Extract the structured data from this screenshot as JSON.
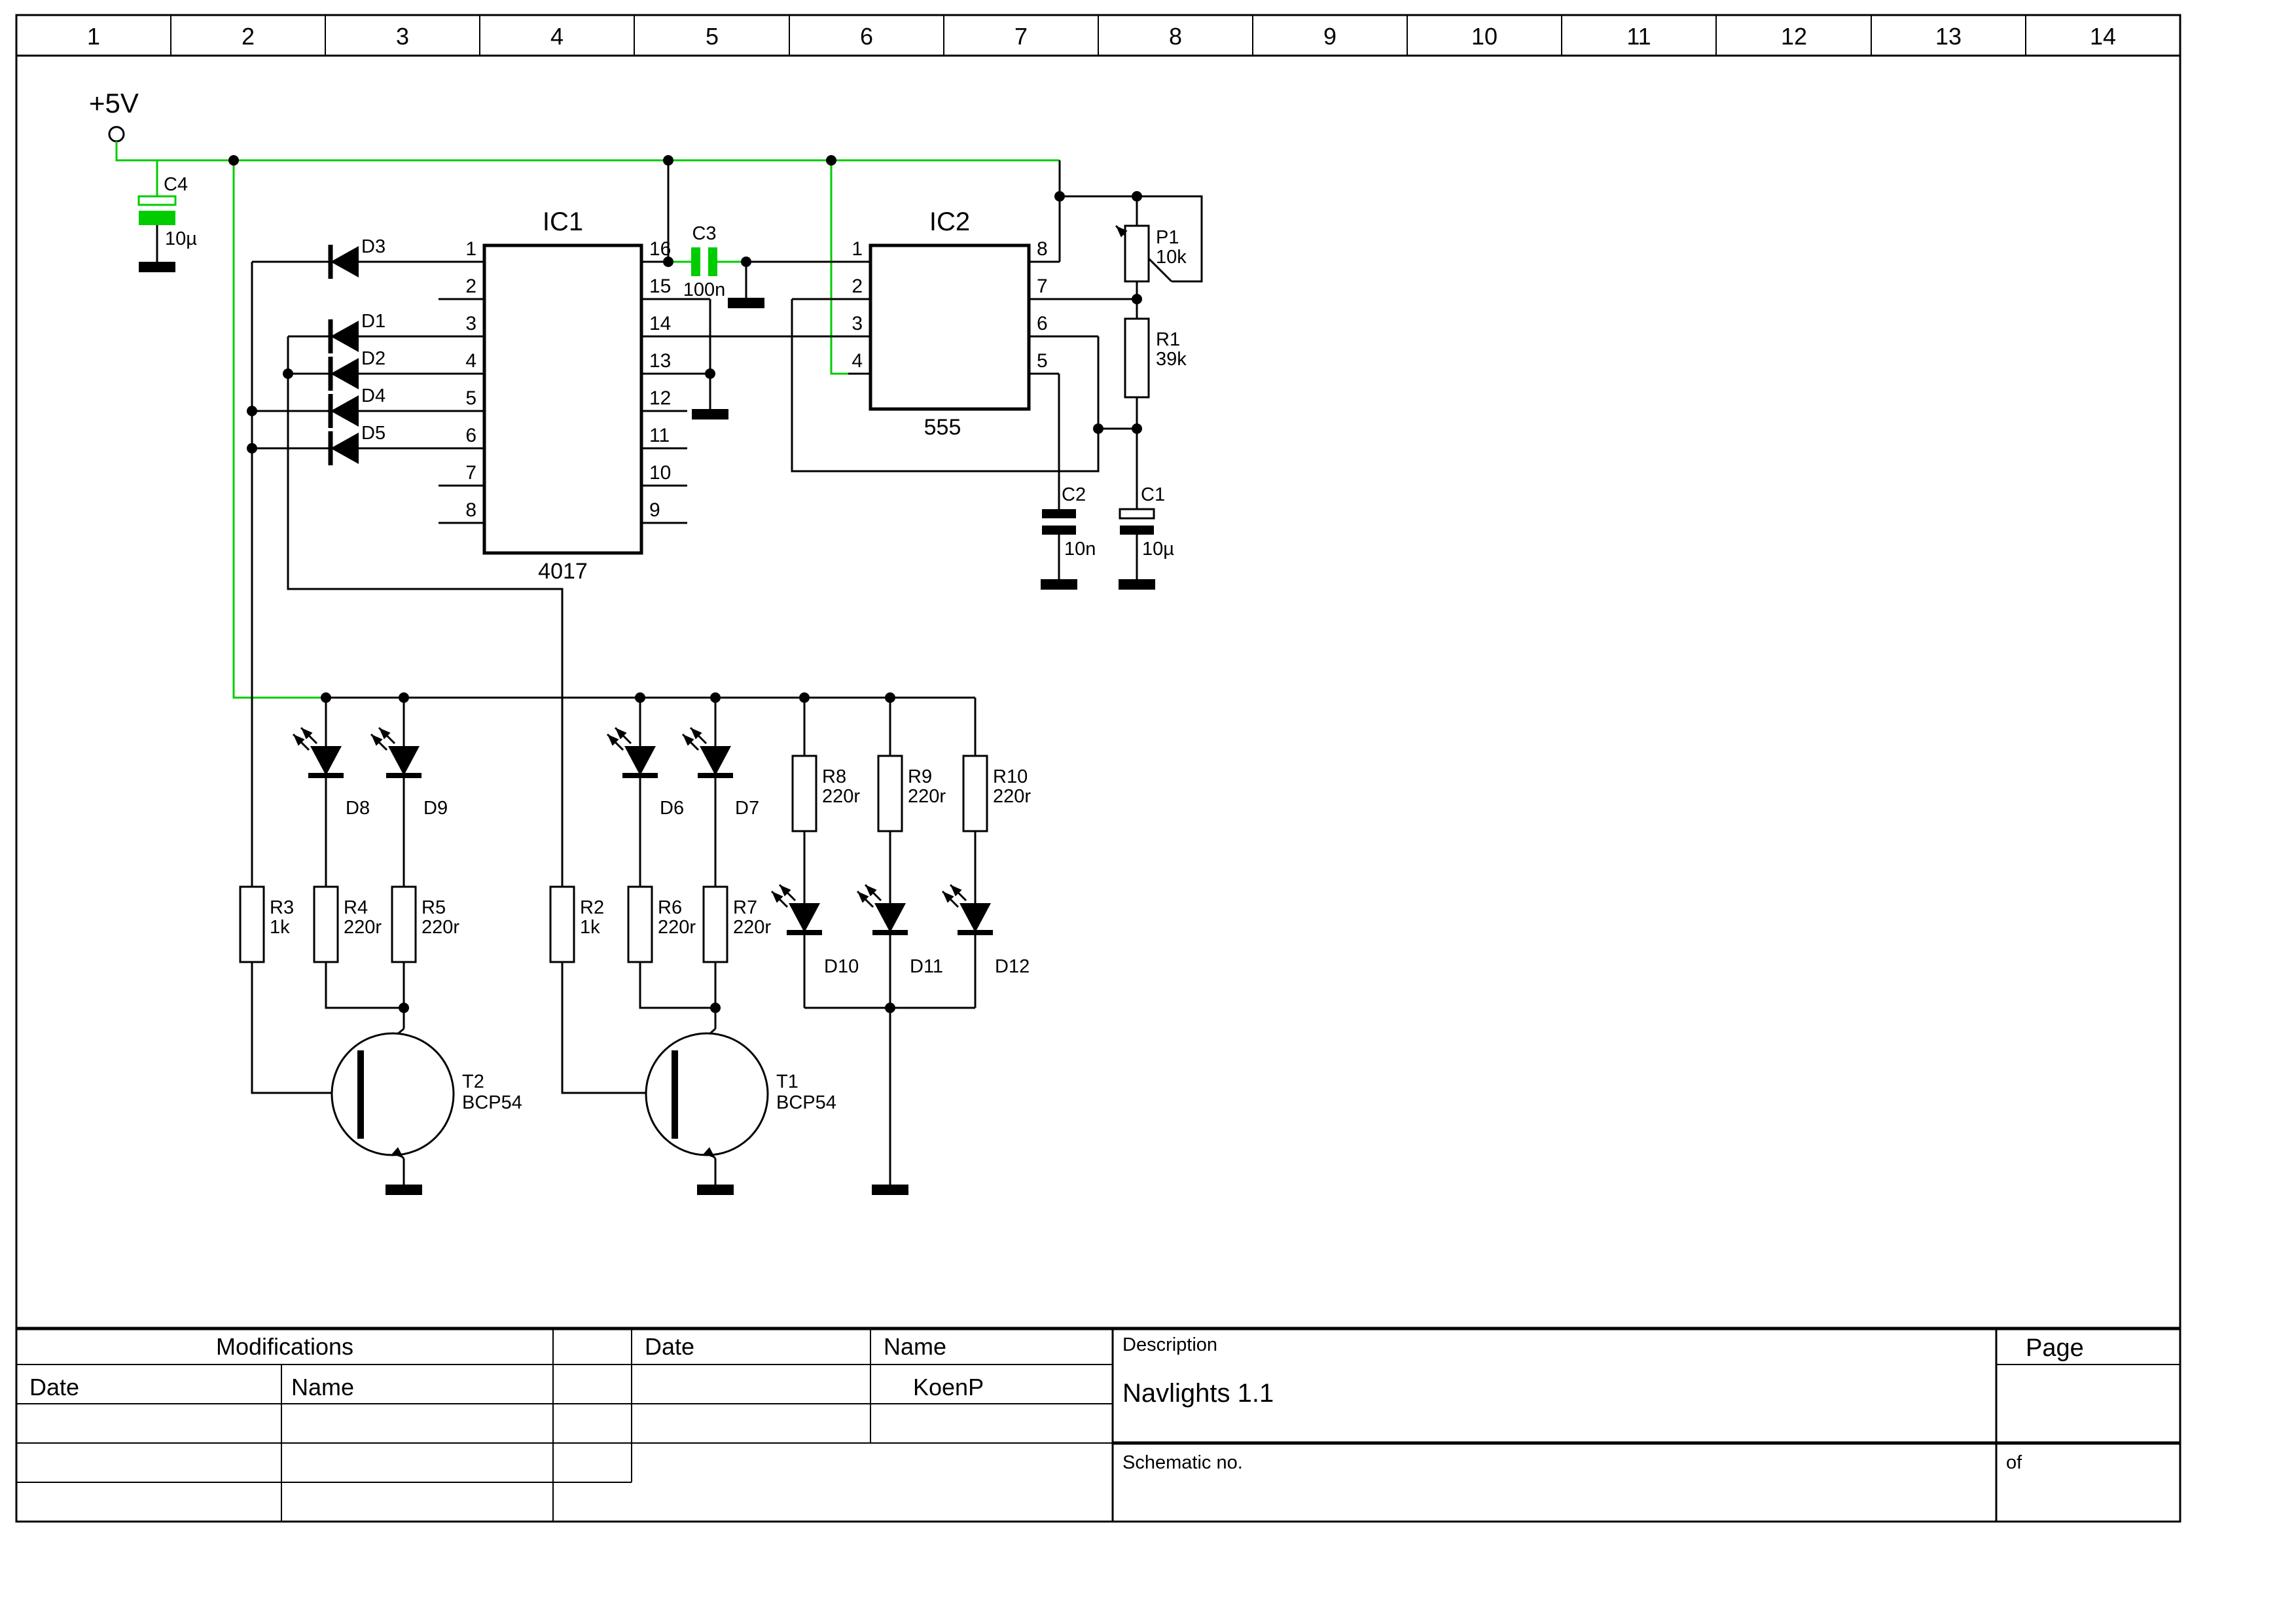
{
  "ruler": [
    "1",
    "2",
    "3",
    "4",
    "5",
    "6",
    "7",
    "8",
    "9",
    "10",
    "11",
    "12",
    "13",
    "14"
  ],
  "power_label": "+5V",
  "ic1": {
    "ref": "IC1",
    "part": "4017",
    "left": [
      "1",
      "2",
      "3",
      "4",
      "5",
      "6",
      "7",
      "8"
    ],
    "right": [
      "16",
      "15",
      "14",
      "13",
      "12",
      "11",
      "10",
      "9"
    ]
  },
  "ic2": {
    "ref": "IC2",
    "part": "555",
    "left": [
      "1",
      "2",
      "3",
      "4"
    ],
    "right": [
      "8",
      "7",
      "6",
      "5"
    ]
  },
  "caps": {
    "c1": [
      "C1",
      "10µ"
    ],
    "c2": [
      "C2",
      "10n"
    ],
    "c3": [
      "C3",
      "100n"
    ],
    "c4": [
      "C4",
      "10µ"
    ]
  },
  "pot": [
    "P1",
    "10k"
  ],
  "res": {
    "r1": [
      "R1",
      "39k"
    ],
    "r2": [
      "R2",
      "1k"
    ],
    "r3": [
      "R3",
      "1k"
    ],
    "r4": [
      "R4",
      "220r"
    ],
    "r5": [
      "R5",
      "220r"
    ],
    "r6": [
      "R6",
      "220r"
    ],
    "r7": [
      "R7",
      "220r"
    ],
    "r8": [
      "R8",
      "220r"
    ],
    "r9": [
      "R9",
      "220r"
    ],
    "r10": [
      "R10",
      "220r"
    ]
  },
  "transistors": {
    "t1": [
      "T1",
      "BCP54"
    ],
    "t2": [
      "T2",
      "BCP54"
    ]
  },
  "diodes": {
    "d1": "D1",
    "d2": "D2",
    "d3": "D3",
    "d4": "D4",
    "d5": "D5",
    "d6": "D6",
    "d7": "D7",
    "d8": "D8",
    "d9": "D9",
    "d10": "D10",
    "d11": "D11",
    "d12": "D12"
  },
  "title_block": {
    "modifications": "Modifications",
    "date_left": "Date",
    "name_left": "Name",
    "date_mid": "Date",
    "name_mid": "Name",
    "author": "KoenP",
    "description_label": "Description",
    "description": "Navlights 1.1",
    "schematic_no_label": "Schematic no.",
    "page_label": "Page",
    "of_label": "of"
  },
  "colors": {
    "green": "#00cc00",
    "black": "#000000"
  }
}
